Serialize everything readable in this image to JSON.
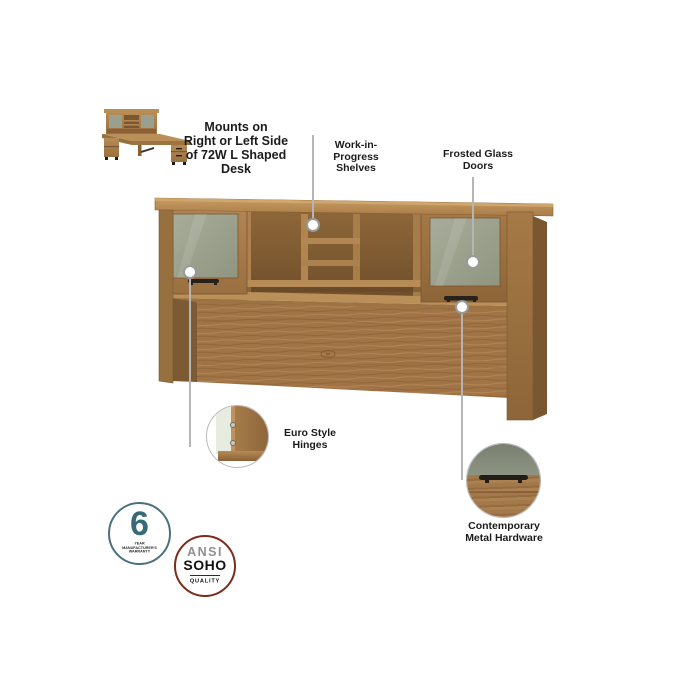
{
  "thumbnail": {
    "caption": "Mounts on\nRight or Left Side\nof 72W L Shaped\nDesk"
  },
  "callouts": {
    "wip_shelves": "Work-in-\nProgress\nShelves",
    "frosted_glass": "Frosted Glass\nDoors",
    "euro_hinges": "Euro Style\nHinges",
    "metal_hardware": "Contemporary\nMetal Hardware"
  },
  "badges": {
    "warranty": {
      "number": "6",
      "label": "YEAR MANUFACTURER'S\nWARRANTY",
      "ring_color": "#4b717f",
      "number_color": "#38697a"
    },
    "quality": {
      "line1": "ANSI",
      "line2": "SOHO",
      "line3": "QUALITY",
      "ring_color": "#7c2a1c"
    }
  },
  "colors": {
    "wood_light": "#c79c63",
    "wood_mid": "#a57a46",
    "wood_dark": "#7a5631",
    "frosted_glass": "#9aa08e",
    "hardware_black": "#211d18",
    "callout_line": "#b5b5b5",
    "label_text": "#1b1b1b",
    "background": "#ffffff"
  }
}
